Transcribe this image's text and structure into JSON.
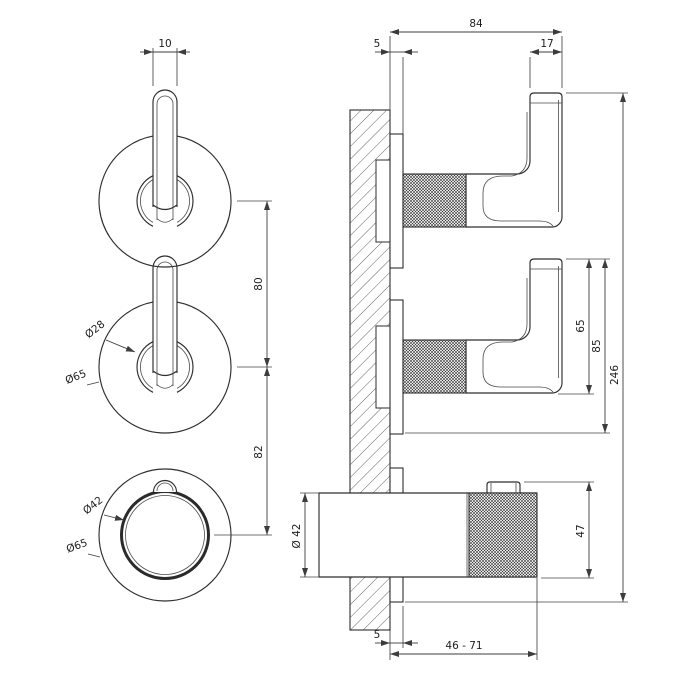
{
  "title": "thermostatic-mixer-technical-drawing",
  "colors": {
    "line": "#2e2e2e",
    "dim": "#3c3c3c",
    "background": "#ffffff"
  },
  "front_view": {
    "dim_lever_width": "10",
    "dim_center_to_center_upper": "80",
    "dim_center_to_center_lower": "82",
    "label_hub_diameter": "Ø28",
    "label_rosette_diameter_middle": "Ø65",
    "label_knob_diameter": "Ø42",
    "label_rosette_diameter_bottom": "Ø65"
  },
  "side_view": {
    "dim_total_projection": "84",
    "dim_plate_thickness_top": "5",
    "dim_lever_bar_width": "17",
    "dim_lever_height": "65",
    "dim_lever_to_plate": "85",
    "dim_total_height": "246",
    "dim_knob_height": "47",
    "label_body_diameter": "Ø 42",
    "dim_plate_thickness_bottom": "5",
    "dim_installation_depth_range": "46 - 71"
  }
}
